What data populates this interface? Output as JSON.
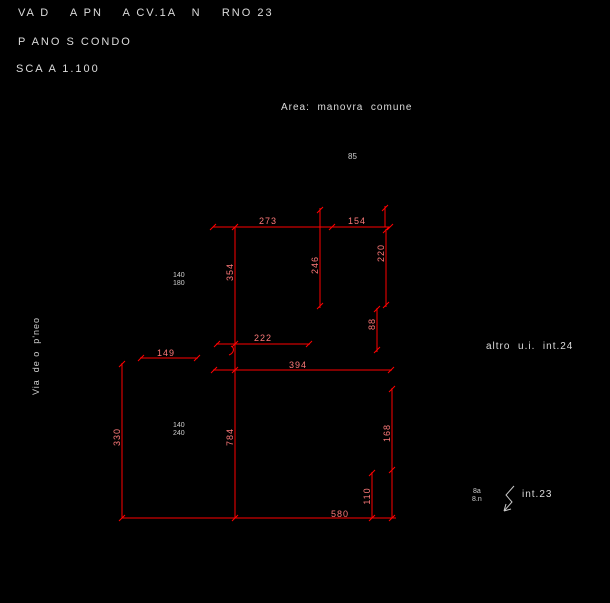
{
  "colors": {
    "background": "#000000",
    "line_red": "#ff0000",
    "dim_text": "#ff7a7a",
    "text_white": "#dcdcdc"
  },
  "header": {
    "address_line": "VA D    A PN    A CV.1A   N    RNO 23",
    "floor_line": "P ANO S CONDO",
    "scale_line": "SCA A 1.100"
  },
  "labels": {
    "area_note": "Area:  manovra  comune",
    "room_number": "85",
    "street_name_vertical": "Via  de o  p'neo",
    "adjacent_unit": "altro  u.i.  int.24",
    "entrance_unit": "int.23",
    "entrance_tag_top": "8a",
    "entrance_tag_bottom": "8.n",
    "window1_width": "140",
    "window1_height": "180",
    "window2_width": "140",
    "window2_height": "240"
  },
  "dimensions": {
    "top_left": "273",
    "top_right": "154",
    "upper_mid_vertical": "246",
    "upper_right_vertical": "220",
    "left_wall_vertical": "354",
    "small_right_vertical": "88",
    "mid_horizontal": "222",
    "left_small_horizontal": "149",
    "mid_long_horizontal": "394",
    "lower_left_vertical": "330",
    "lower_mid_vertical": "784",
    "lower_right_vertical": "168",
    "bottom_right_vertical": "110",
    "bottom_total": "580"
  }
}
